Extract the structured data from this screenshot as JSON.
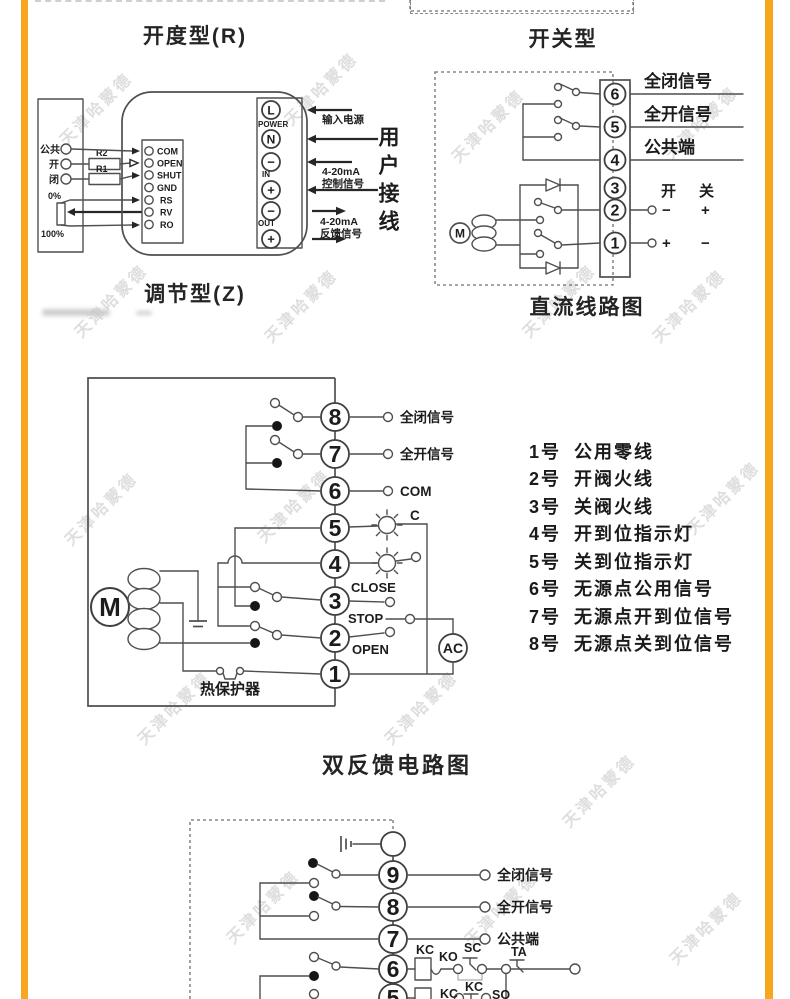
{
  "watermark": "天津哈蒙德",
  "accent_color": "#F6A71F",
  "regulating": {
    "title": "开度型(R)",
    "subtitle": "调节型(Z)",
    "left_box": {
      "terminals": [
        "公共",
        "开",
        "闭"
      ],
      "resistors": [
        "R2",
        "R1"
      ],
      "pot_top": "0%",
      "pot_bottom": "100%"
    },
    "module": {
      "terminals": [
        "COM",
        "OPEN",
        "SHUT",
        "GND",
        "RS",
        "RV",
        "RO"
      ]
    },
    "power": {
      "terminals": [
        "L",
        "N",
        "−",
        "+",
        "−",
        "+"
      ],
      "groups": [
        "POWER",
        "IN",
        "OUT"
      ]
    },
    "annotations": {
      "power_in": "输入电源",
      "ctrl_line1": "4-20mA",
      "ctrl_line2": "控制信号",
      "fb_line1": "4-20mA",
      "fb_line2": "反馈信号",
      "side": "用户接线"
    }
  },
  "switch_type": {
    "title": "开关型",
    "caption": "直流线路图",
    "motor": "M",
    "terminals": [
      "6",
      "5",
      "4",
      "3",
      "2",
      "1"
    ],
    "signal_labels": [
      "全闭信号",
      "全开信号",
      "公共端"
    ],
    "open_label": "开",
    "close_label": "关",
    "row2": [
      "−",
      "+"
    ],
    "row1": [
      "+",
      "−"
    ]
  },
  "feedback": {
    "title": "双反馈电路图",
    "motor": "M",
    "ac": "AC",
    "thermal": "热保护器",
    "terminals": [
      "8",
      "7",
      "6",
      "5",
      "4",
      "3",
      "2",
      "1"
    ],
    "t8": "全闭信号",
    "t7": "全开信号",
    "t6": "COM",
    "lamp": "C",
    "close": "CLOSE",
    "stop": "STOP",
    "open": "OPEN",
    "legend": [
      {
        "no": "1号",
        "text": "公用零线"
      },
      {
        "no": "2号",
        "text": "开阀火线"
      },
      {
        "no": "3号",
        "text": "关阀火线"
      },
      {
        "no": "4号",
        "text": "开到位指示灯"
      },
      {
        "no": "5号",
        "text": "关到位指示灯"
      },
      {
        "no": "6号",
        "text": "无源点公用信号"
      },
      {
        "no": "7号",
        "text": "无源点开到位信号"
      },
      {
        "no": "8号",
        "text": "无源点关到位信号"
      }
    ]
  },
  "dc_feedback": {
    "terminals": [
      "9",
      "8",
      "7",
      "6",
      "5"
    ],
    "t9": "全闭信号",
    "t8": "全开信号",
    "t7": "公共端",
    "kc": "KC",
    "ko": "KO",
    "sc": "SC",
    "ta": "TA",
    "kc2": "KC",
    "kc3": "KC",
    "so": "SO"
  }
}
